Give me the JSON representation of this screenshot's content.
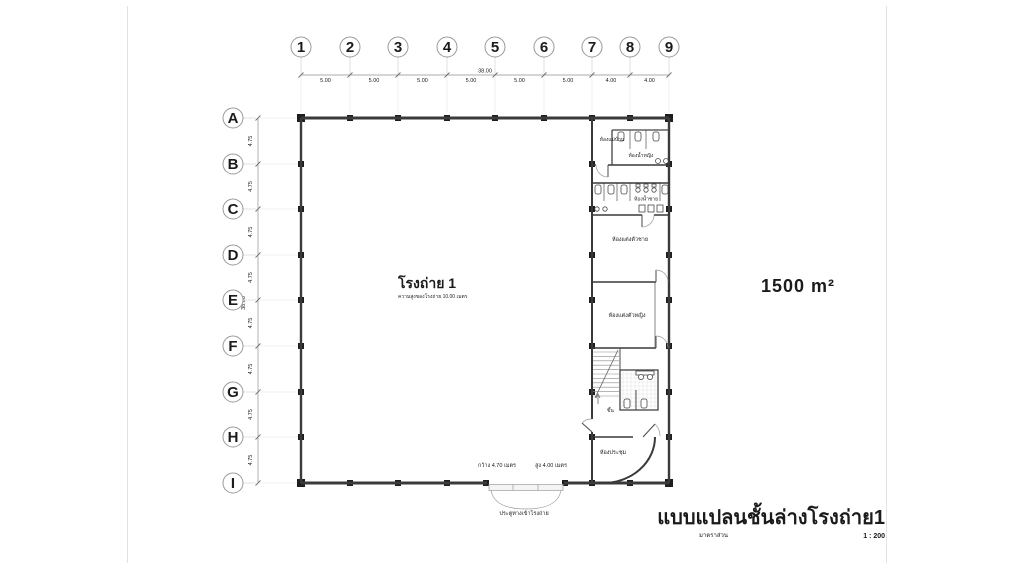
{
  "sheet": {
    "area_label": "1500 m²"
  },
  "grid": {
    "columns": [
      "1",
      "2",
      "3",
      "4",
      "5",
      "6",
      "7",
      "8",
      "9"
    ],
    "rows": [
      "A",
      "B",
      "C",
      "D",
      "E",
      "F",
      "G",
      "H",
      "I"
    ]
  },
  "dims": {
    "top": {
      "total": "38.00",
      "segments": [
        "5.00",
        "5.00",
        "5.00",
        "5.00",
        "5.00",
        "5.00",
        "4.00",
        "4.00"
      ]
    },
    "left": {
      "total": "38.00",
      "segments": [
        "4.75",
        "4.75",
        "4.75",
        "4.75",
        "4.75",
        "4.75",
        "4.75",
        "4.75"
      ]
    }
  },
  "hall": {
    "name": "โรงถ่าย 1",
    "height_note": "ความสูงของโรงถ่าย 10.00 เมตร"
  },
  "rooms": {
    "maid_room": "ห้องแม่บ้าน",
    "toilet_women": "ห้องน้ำหญิง",
    "toilet_men": "ห้องน้ำชาย",
    "dressing_men": "ห้องแต่งตัวชาย",
    "dressing_women": "ห้องแต่งตัวหญิง",
    "meeting_room": "ห้องประชุม",
    "stair_up": "ขึ้น"
  },
  "entrance": {
    "width_label": "กว้าง 4.70 เมตร",
    "height_label": "สูง 4.00 เมตร",
    "name_label": "ประตูทางเข้าโรงถ่าย"
  },
  "title_block": {
    "title": "แบบแปลนชั้นล่างโรงถ่าย1",
    "scale_caption": "มาตราส่วน",
    "scale_value": "1 : 200"
  }
}
